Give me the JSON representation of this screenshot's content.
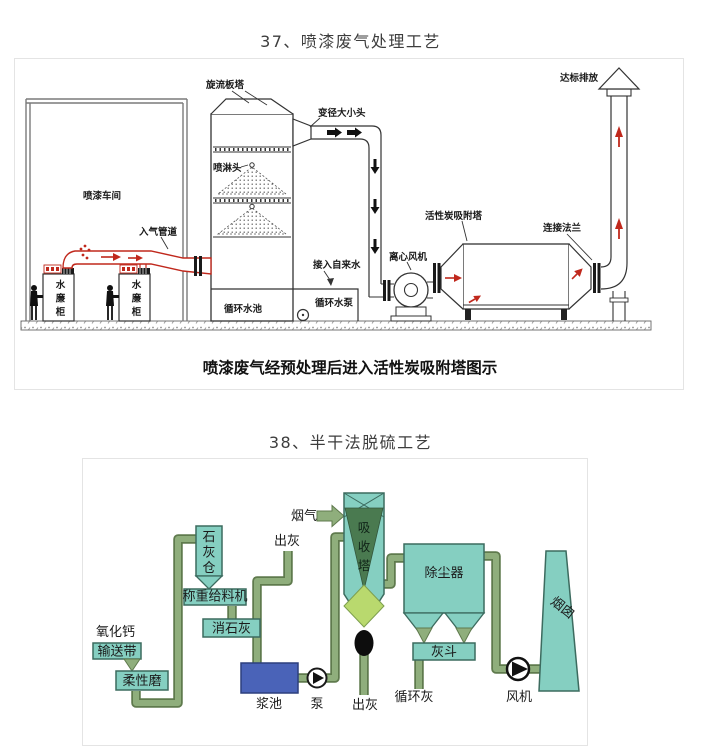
{
  "page": {
    "heading_37": "37、喷漆废气处理工艺",
    "heading_38": "38、半干法脱硫工艺"
  },
  "diagram1": {
    "caption": "喷漆废气经预处理后进入活性炭吸附塔图示",
    "labels": {
      "workshop": "喷漆车间",
      "inlet_duct": "入气管道",
      "booth": "水廉柜",
      "swirl_tower": "旋流板塔",
      "spray_nozzle": "喷淋头",
      "reducer": "变径大小头",
      "tap_water": "接入自来水",
      "pool": "循环水池",
      "pool_pump": "循环水泵",
      "centrifugal_fan": "离心风机",
      "carbon_tower": "活性炭吸附塔",
      "flange": "连接法兰",
      "discharge": "达标排放"
    },
    "colors": {
      "line": "#333333",
      "red_accent": "#c0281c"
    }
  },
  "diagram2": {
    "labels": {
      "calcium_oxide": "氧化钙",
      "conveyor_belt": "输送带",
      "flexible_mill": "柔性磨",
      "lime_silo": "石灰仓",
      "weighing_feeder": "称重给料机",
      "slaked_lime": "消石灰",
      "ash_out_top": "出灰",
      "slurry_tank": "浆池",
      "pump": "泵",
      "flue_gas": "烟气",
      "absorber_tower": "吸收塔",
      "ash_out_bottom": "出灰",
      "dust_collector": "除尘器",
      "ash_hopper": "灰斗",
      "circulating_ash": "循环灰",
      "fan": "风机",
      "chimney": "烟囱"
    },
    "colors": {
      "equipment_teal": "#85cfc1",
      "slurry_blue": "#4a63b8",
      "pipe_green": "#8fae7c",
      "pipe_dark": "#5f7a4d",
      "absorber_dark_green": "#4a7a50",
      "lime_yellow_green": "#b9d96e"
    }
  }
}
